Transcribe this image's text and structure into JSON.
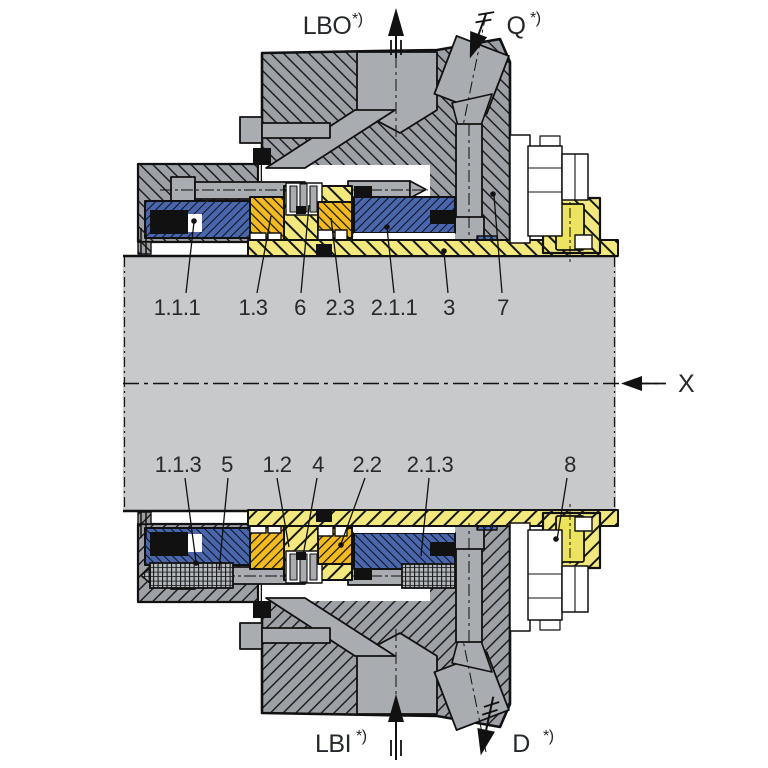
{
  "diagram": {
    "kind": "mechanical-seal-cross-section",
    "flow_ports": {
      "lbo": {
        "label": "LBO",
        "suffix": "*)"
      },
      "q": {
        "label": "Q",
        "suffix": "*)"
      },
      "lbi": {
        "label": "LBI",
        "suffix": "*)"
      },
      "d": {
        "label": "D",
        "suffix": "*)"
      }
    },
    "section_axis": {
      "label": "X"
    },
    "part_labels_top": [
      "1.1.1",
      "1.3",
      "6",
      "2.3",
      "2.1.1",
      "3",
      "7"
    ],
    "part_labels_bottom": [
      "1.1.3",
      "5",
      "1.2",
      "4",
      "2.2",
      "2.1.3",
      "8"
    ],
    "colors": {
      "housing_gray": "#9da1a6",
      "machined_gray": "#a9acb0",
      "shaft_gray": "#c7c9cb",
      "sleeve_yellow": "#f2e87e",
      "screw_yellow": "#ece45f",
      "seal_face_orange": "#f5ba1e",
      "ring_blue": "#4a66ad",
      "outline_black": "#111111"
    }
  }
}
